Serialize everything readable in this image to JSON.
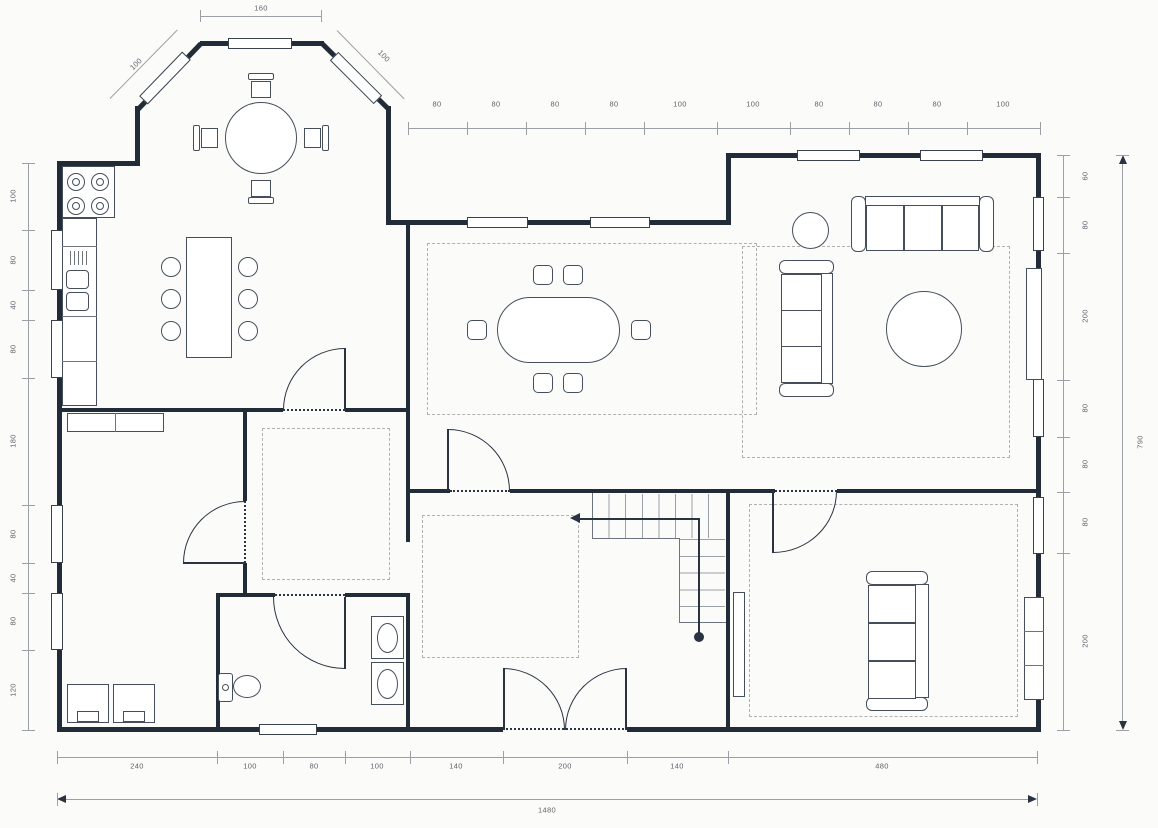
{
  "title": "house-floor-plan",
  "dims": {
    "bay": {
      "width": "160",
      "left_diag": "100",
      "right_diag": "100"
    },
    "top": {
      "values": [
        "80",
        "80",
        "80",
        "80",
        "100",
        "100",
        "80",
        "80",
        "80",
        "100"
      ]
    },
    "left": {
      "values": [
        "100",
        "80",
        "40",
        "80",
        "180",
        "80",
        "40",
        "80",
        "120"
      ]
    },
    "right": {
      "values": [
        "60",
        "80",
        "200",
        "80",
        "80",
        "80",
        "200"
      ],
      "total": "790"
    },
    "bottom": {
      "values": [
        "240",
        "100",
        "80",
        "100",
        "140",
        "200",
        "140",
        "480"
      ],
      "total": "1480"
    }
  },
  "colors": {
    "wall": "#222c39",
    "furniture_line": "#454f5b",
    "dimension_line": "#9aa0a6",
    "label_text": "#5f646b",
    "rug_dash": "#b1b1b1",
    "background": "#fbfbf9"
  }
}
